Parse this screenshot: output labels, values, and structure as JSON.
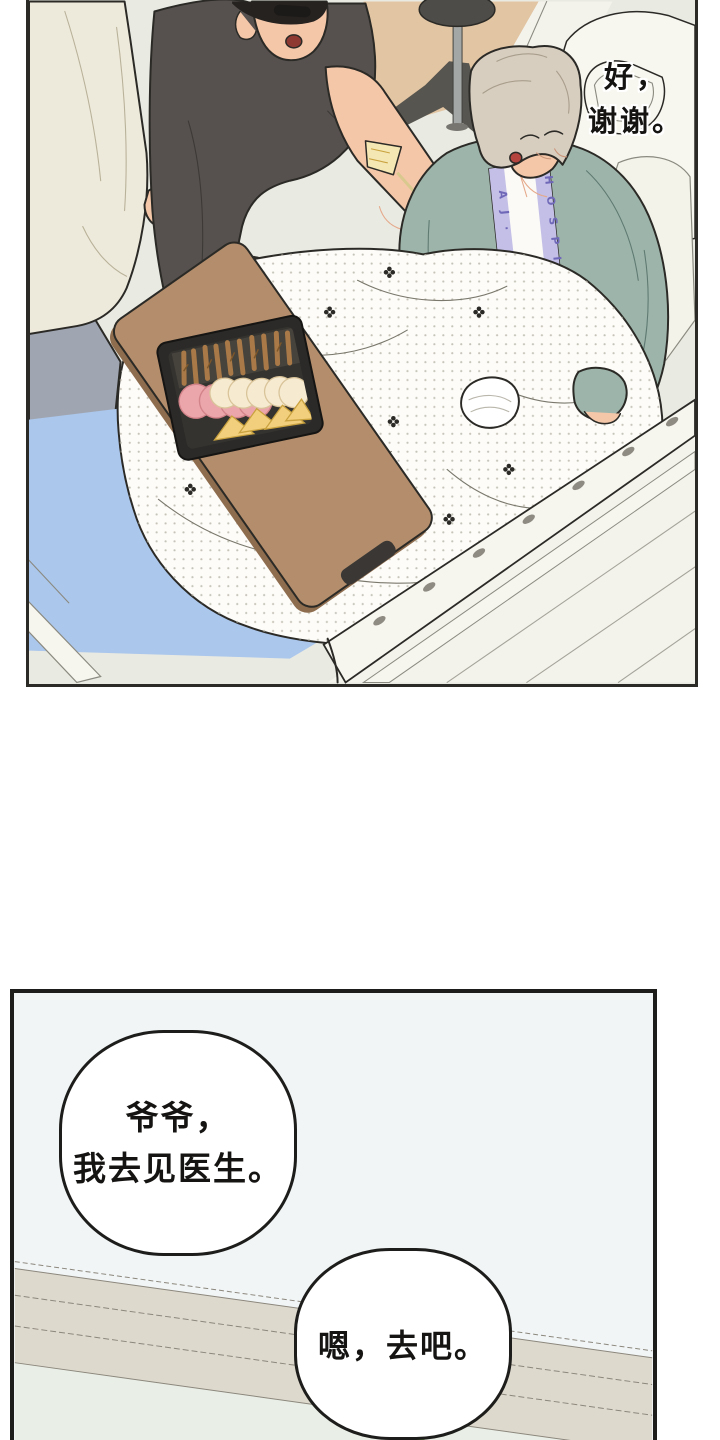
{
  "panel1": {
    "dialogue_line1": "好，",
    "dialogue_line2": "谢谢。",
    "gown_text_left": "A J ·",
    "gown_text_right": "H O S P I T A L"
  },
  "panel2": {
    "bubble1_line1": "爷爷，",
    "bubble1_line2": "我去见医生。",
    "bubble2_text": "嗯，去吧。"
  },
  "colors": {
    "page_bg": "#ffffff",
    "wall": "#e9eae2",
    "line": "#2b2a26",
    "floor_white": "#f3f3ec",
    "floor_tan": "#e2c5a3",
    "shirt_cream": "#eeeadb",
    "shirt_line": "#b9b29a",
    "pants_gray": "#9fa6b2",
    "skin": "#f5c7a9",
    "skin_shade": "#e5a98b",
    "hair_black": "#262220",
    "tee_dark": "#56514e",
    "bag_dark": "#4b4744",
    "mouth_dark": "#8e3a33",
    "hair_gray": "#d8cec0",
    "cardigan": "#9db4aa",
    "cardigan_line": "#5f7a72",
    "gown_white": "#fbfaf6",
    "gown_trim": "#c3bfe6",
    "gown_letter": "#6f68b8",
    "mouth_red": "#b5443f",
    "blanket": "#fdfcf8",
    "blanket_dot": "#b3b0a3",
    "blanket_fold": "#7a786c",
    "table": "#b48e6c",
    "table_side": "#8e6c4e",
    "handle": "#3a3734",
    "tray": "#2b2a28",
    "tray_inner": "#35332f",
    "pretzel": "#a97a47",
    "pretzel_dark": "#7d5629",
    "ham": "#eba6ab",
    "ham_edge": "#d2838a",
    "cracker": "#f6ead0",
    "cracker_edge": "#d9c49a",
    "cheese": "#f2cf7d",
    "cheese_edge": "#c9a23f",
    "snack": "#f5e7b4",
    "mattress": "#abc7ec",
    "frame_white": "#f6f5ee",
    "frame_line": "#8b8a80",
    "slot": "#8e8c82",
    "pole": "#a3a7a6",
    "base_dark": "#57554f",
    "headboard": "#f7f6ef",
    "pillow": "#f4f3ea",
    "bandage": "#ffffff",
    "p2_wall": "#f1f5f6",
    "p2_band": "#ded9cd",
    "p2_band_line": "#8c877d",
    "p2_floor": "#e9efe6",
    "bubble_bg": "#ffffff",
    "bubble_border": "#1d1d1b",
    "text": "#151412",
    "leaf": "#9cc878",
    "leaf_dark": "#6f9e4a"
  }
}
